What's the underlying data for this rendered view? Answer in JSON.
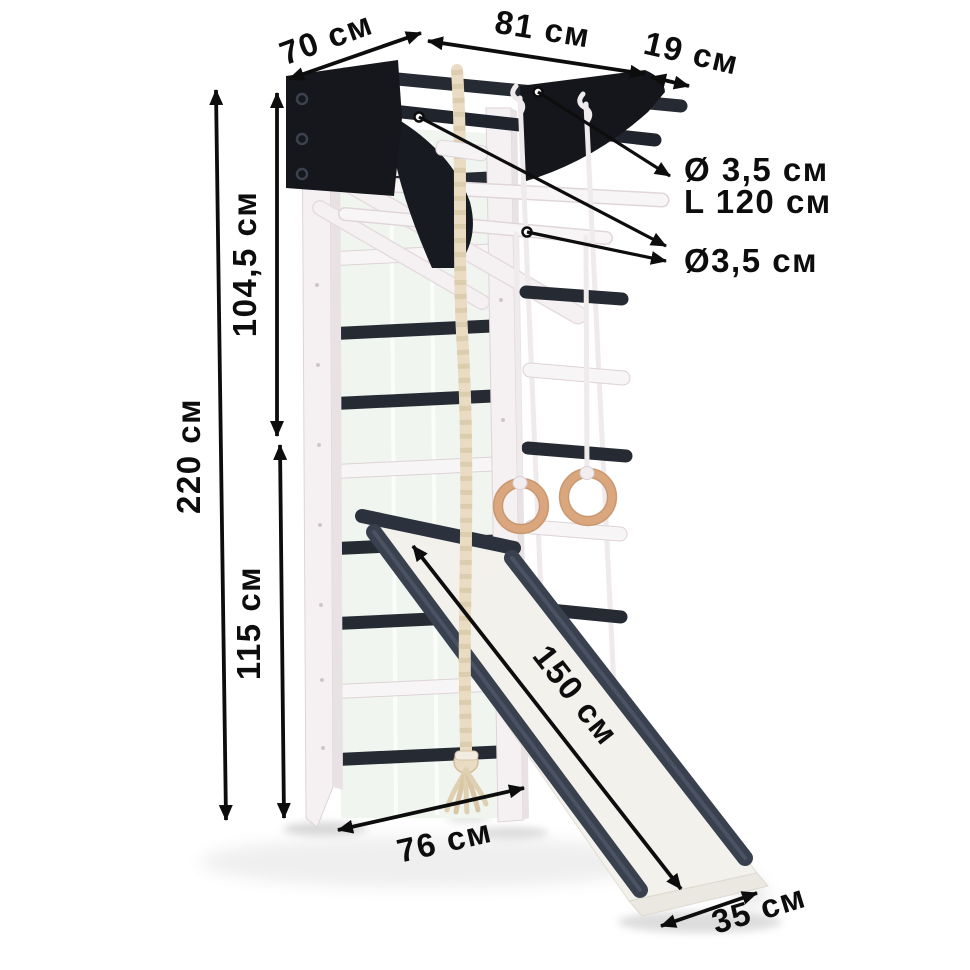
{
  "page": {
    "kind": "product-dimension-diagram",
    "background": "#ffffff"
  },
  "scene": {
    "parts": [
      "wall-bars-ladder",
      "pull-up-bar-bracket",
      "fold-out-beam",
      "climbing-rope",
      "gymnastic-rings",
      "rope-ladder",
      "slide"
    ]
  },
  "labels": {
    "depth_top": "70 см",
    "bar_span": "81 см",
    "bar_overhang": "19 см",
    "bar_diameter": "Ø 3,5 см",
    "bar_length": "L 120 см",
    "rung_diameter": "Ø3,5 см",
    "upper_section_height": "104,5 см",
    "total_height": "220 см",
    "lower_section_height": "115 см",
    "base_depth": "76 см",
    "slide_length": "150 см",
    "slide_width": "35 см"
  },
  "colors": {
    "annotation_text": "#0d0d0d",
    "metal_black": "#15171d",
    "dark_rung": "#262b33",
    "white_wood": "#f5f1f2",
    "wall_tint": "#f0f5f0",
    "rope_beige": "#e9dcc3",
    "ring_wood": "#d9a67e",
    "slide_rail": "#39404e",
    "background": "#ffffff"
  }
}
